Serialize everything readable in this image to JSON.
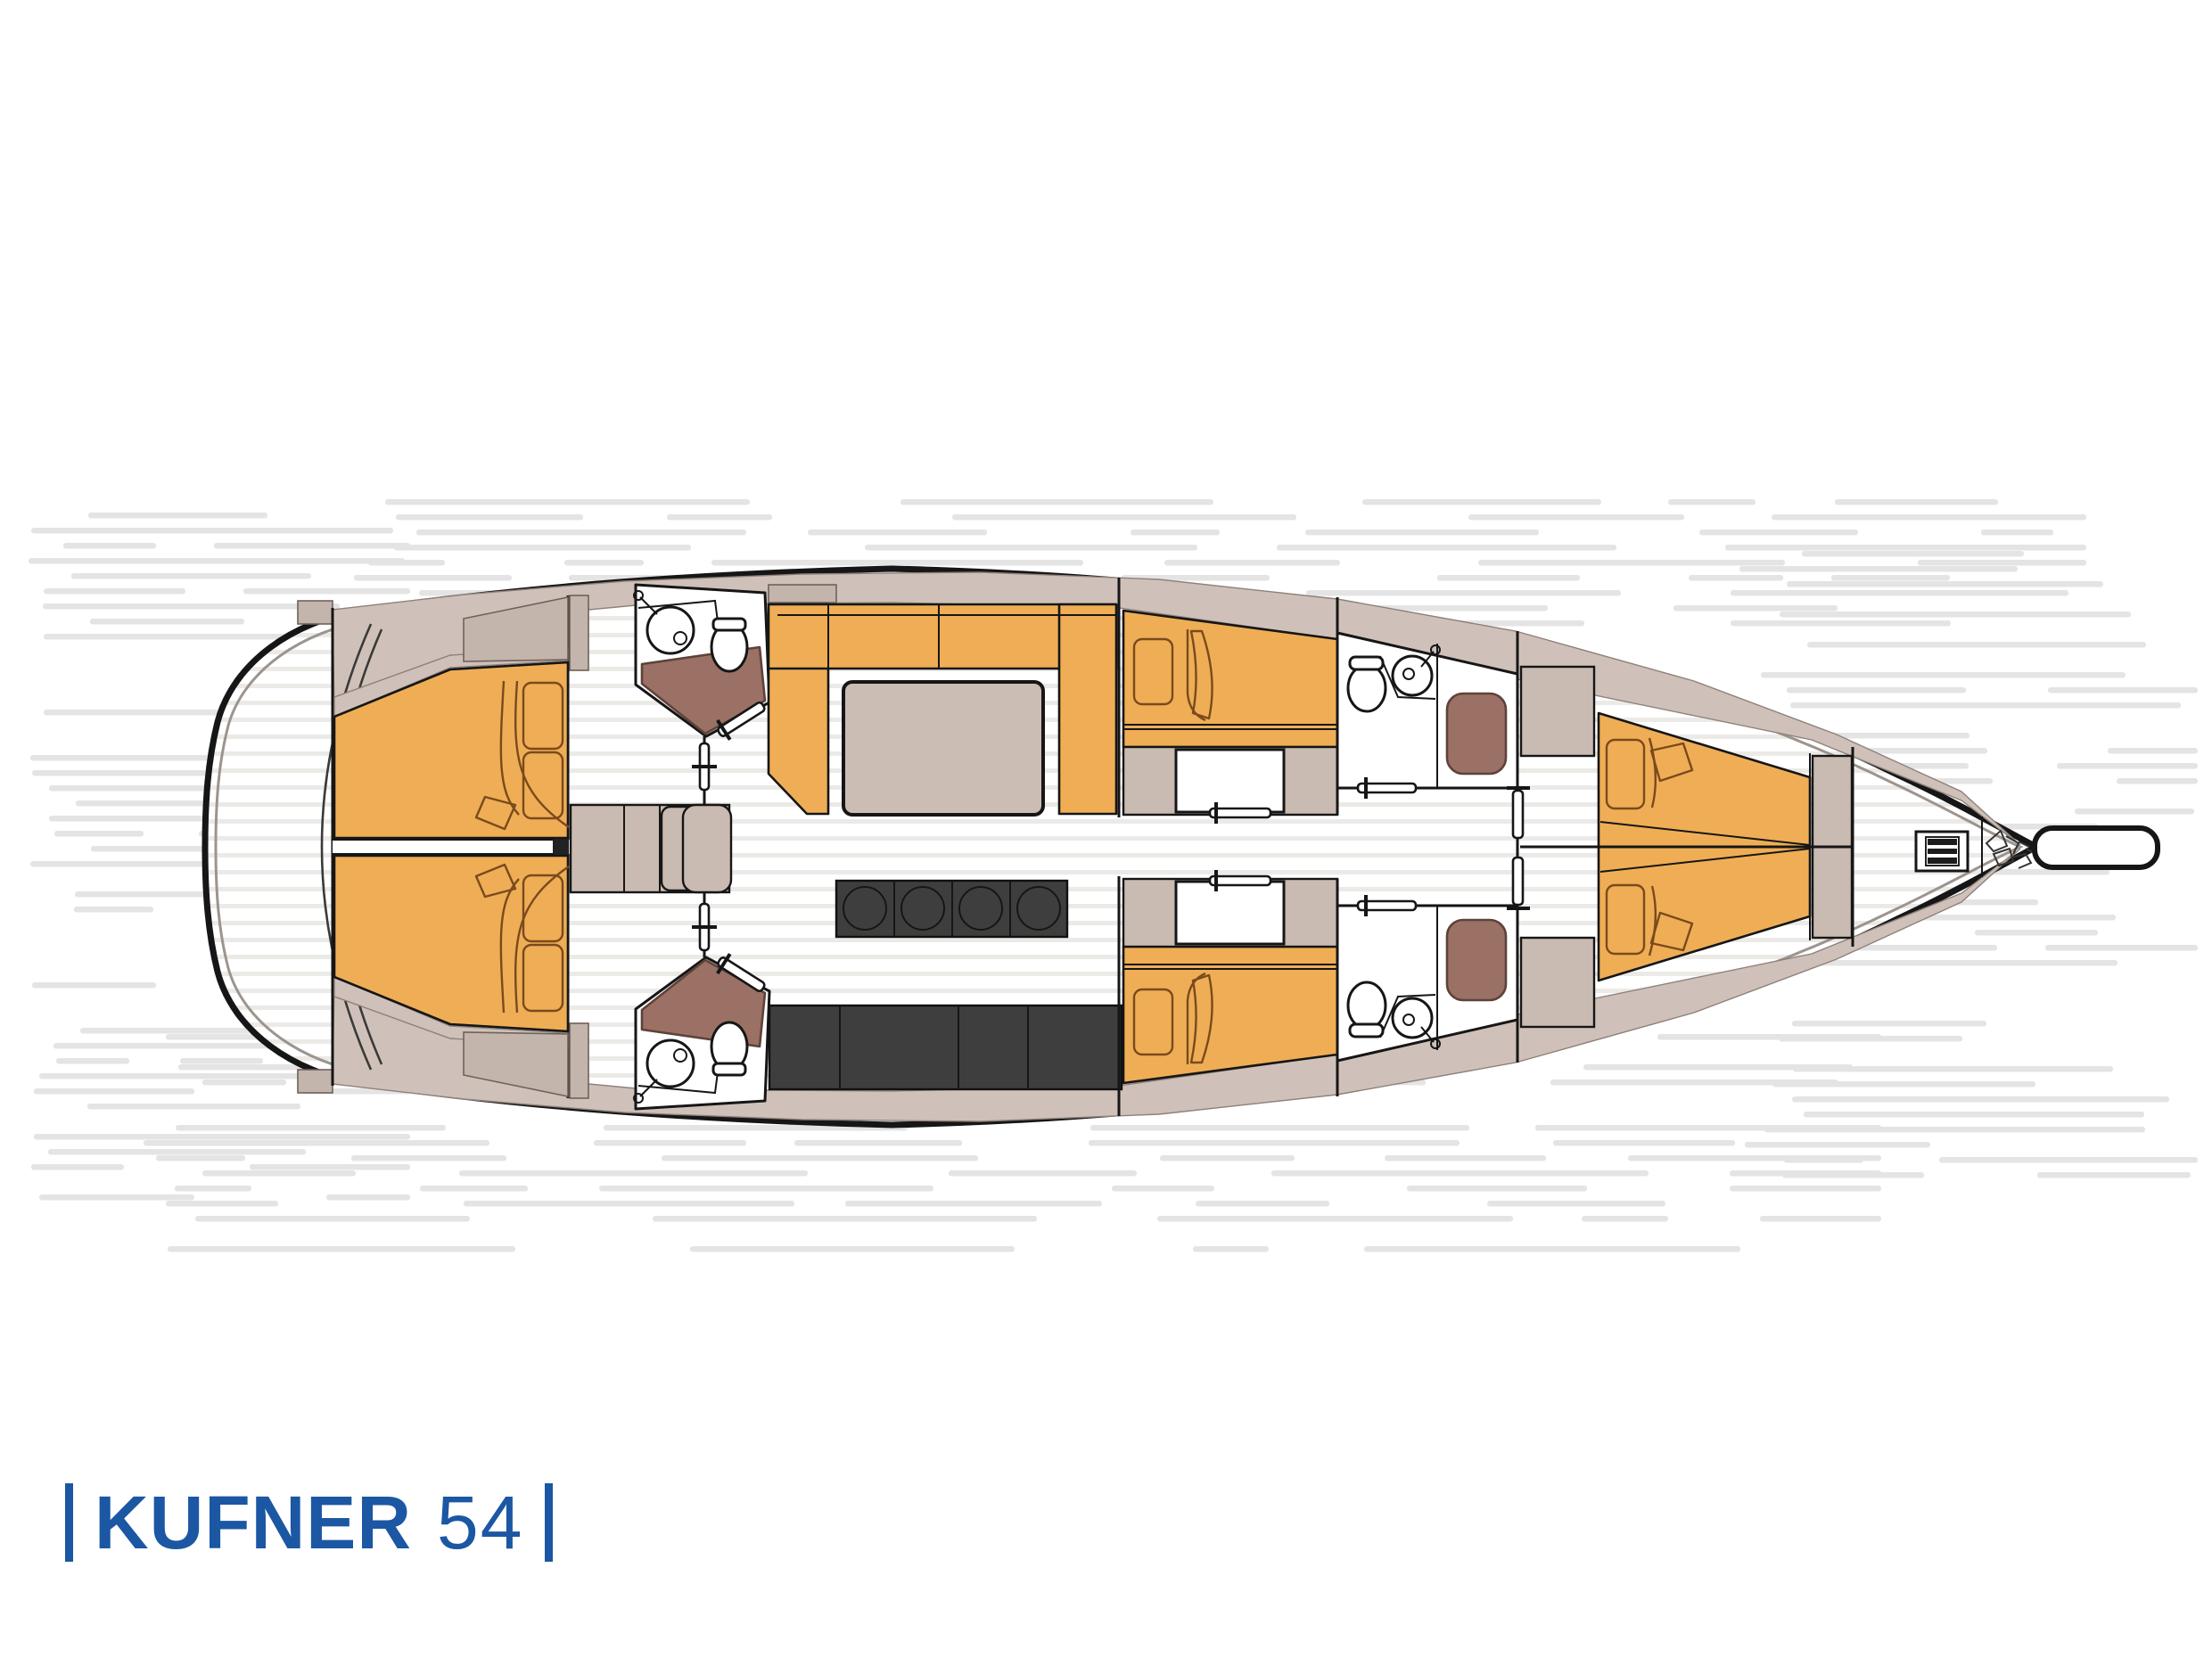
{
  "branding": {
    "left_bar": "|",
    "brand": "KUFNER",
    "model": "54",
    "right_bar": "|"
  },
  "colors": {
    "logo_blue": "#1b57a3",
    "ink": "#161616",
    "deck_taupe": "#cfc1b9",
    "furn_taupe": "#c9bab2",
    "table_taupe": "#cbbcb4",
    "orange": "#efae55",
    "soft_line": "#7a4a1e",
    "brown": "#9a7164",
    "dark": "#3e3e3e",
    "floor_stripe": "#eceae7",
    "hatch": "#e4e4e4",
    "hull_gray": "#9c948d"
  },
  "plan_icons": [
    {
      "icon": "stern-swim-platform"
    },
    {
      "icon": "aft-double-cabin-port"
    },
    {
      "icon": "aft-double-cabin-starboard"
    },
    {
      "icon": "aft-head-with-shower-port"
    },
    {
      "icon": "aft-head-with-shower-starboard"
    },
    {
      "icon": "companionway-steps"
    },
    {
      "icon": "salon-l-sofa"
    },
    {
      "icon": "salon-table"
    },
    {
      "icon": "stool-row-4"
    },
    {
      "icon": "galley-counter"
    },
    {
      "icon": "mid-cabin-port"
    },
    {
      "icon": "mid-cabin-starboard"
    },
    {
      "icon": "mid-head-port"
    },
    {
      "icon": "mid-head-starboard"
    },
    {
      "icon": "forward-v-berth"
    },
    {
      "icon": "anchor-windlass"
    },
    {
      "icon": "anchor-chain"
    },
    {
      "icon": "bowsprit"
    }
  ]
}
